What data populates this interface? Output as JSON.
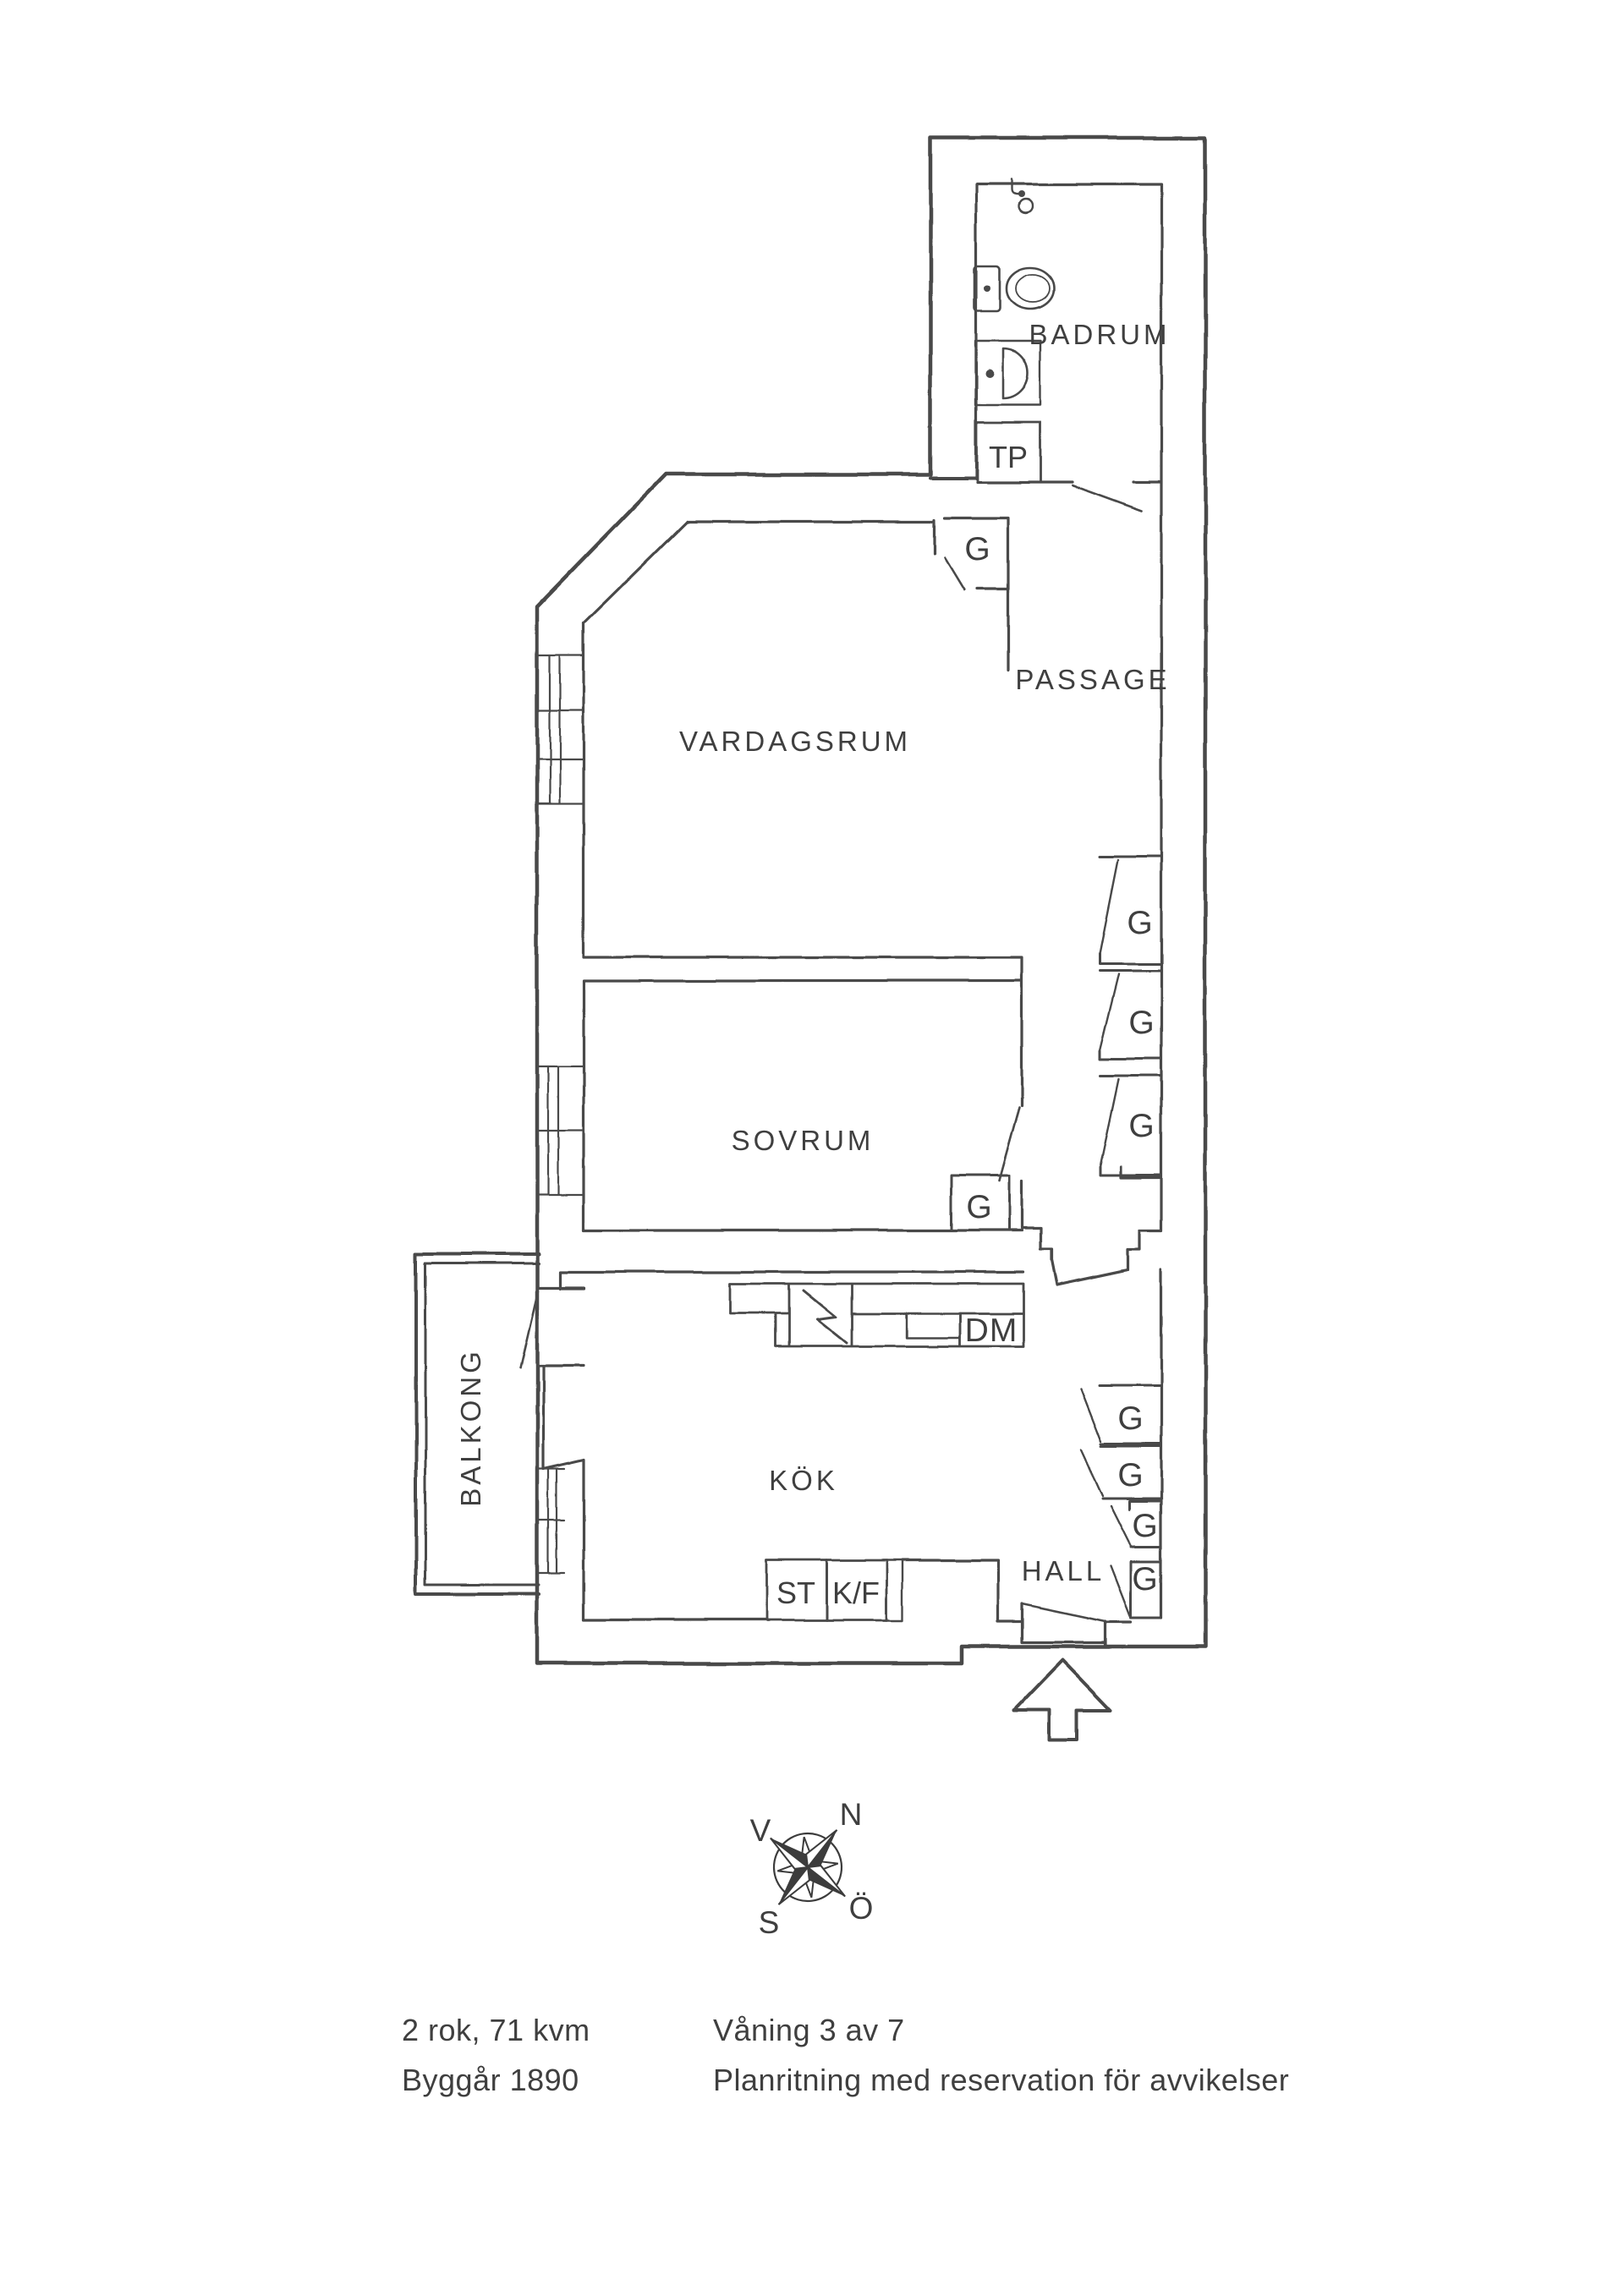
{
  "page": {
    "background": "#ffffff",
    "ink_color": "#3f3f3f",
    "wall_color": "#484848"
  },
  "plan": {
    "rooms": {
      "badrum": "BADRUM",
      "passage": "PASSAGE",
      "vardagsrum": "VARDAGSRUM",
      "sovrum": "SOVRUM",
      "kok": "KÖK",
      "hall": "HALL",
      "balkong": "BALKONG"
    },
    "fixtures": {
      "tp": "TP",
      "dm": "DM",
      "st": "ST",
      "kf": "K/F",
      "wardrobe": "G"
    }
  },
  "compass": {
    "north": "N",
    "west": "V",
    "south": "S",
    "east": "Ö"
  },
  "footer": {
    "rooms_area": "2 rok, 71 kvm",
    "build_year": "Byggår 1890",
    "floor": "Våning 3 av 7",
    "disclaimer": "Planritning med reservation för avvikelser"
  }
}
